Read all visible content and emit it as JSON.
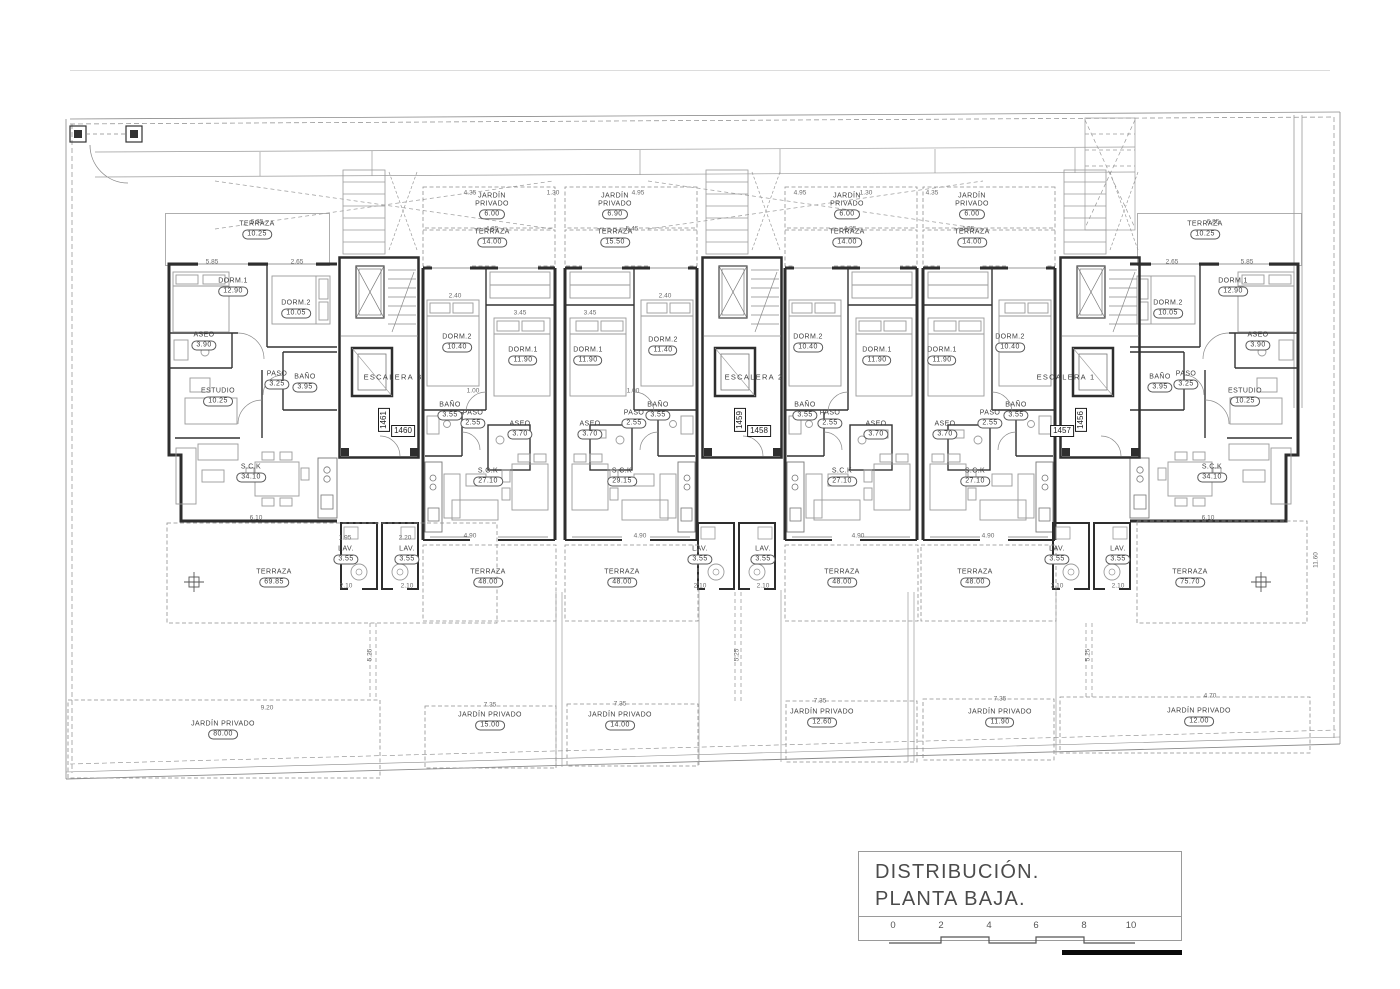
{
  "title_block": {
    "line1": "DISTRIBUCIÓN.",
    "line2": "PLANTA BAJA.",
    "scale_ticks": [
      "0",
      "2",
      "4",
      "6",
      "8",
      "10"
    ]
  },
  "stairwells": [
    {
      "label": "ESCALERA 3",
      "x": 393,
      "y": 377
    },
    {
      "label": "ESCALERA 2",
      "x": 754,
      "y": 377
    },
    {
      "label": "ESCALERA 1",
      "x": 1066,
      "y": 377
    }
  ],
  "plot_numbers": [
    {
      "num": "1461",
      "x": 384,
      "y": 420,
      "vertical": true
    },
    {
      "num": "1460",
      "x": 403,
      "y": 431,
      "vertical": false
    },
    {
      "num": "1459",
      "x": 740,
      "y": 420,
      "vertical": true
    },
    {
      "num": "1458",
      "x": 759,
      "y": 431,
      "vertical": false
    },
    {
      "num": "1457",
      "x": 1062,
      "y": 431,
      "vertical": false
    },
    {
      "num": "1456",
      "x": 1081,
      "y": 420,
      "vertical": true
    }
  ],
  "rooms": [
    {
      "unit": 1,
      "name": "TERRAZA",
      "area": "10.25",
      "x": 257,
      "y": 230
    },
    {
      "unit": 1,
      "name": "DORM.1",
      "area": "12.90",
      "x": 233,
      "y": 287
    },
    {
      "unit": 1,
      "name": "DORM.2",
      "area": "10.05",
      "x": 296,
      "y": 309
    },
    {
      "unit": 1,
      "name": "ASEO",
      "area": "3.90",
      "x": 204,
      "y": 341
    },
    {
      "unit": 1,
      "name": "PASO",
      "area": "3.25",
      "x": 277,
      "y": 380
    },
    {
      "unit": 1,
      "name": "BAÑO",
      "area": "3.95",
      "x": 305,
      "y": 383
    },
    {
      "unit": 1,
      "name": "ESTUDIO",
      "area": "10.25",
      "x": 218,
      "y": 397
    },
    {
      "unit": 1,
      "name": "S.C.K",
      "area": "34.10",
      "x": 251,
      "y": 473
    },
    {
      "unit": 1,
      "name": "LAV.",
      "area": "3.55",
      "x": 346,
      "y": 555
    },
    {
      "unit": 1,
      "name": "TERRAZA",
      "area": "69.85",
      "x": 274,
      "y": 578
    },
    {
      "unit": 1,
      "name": "JARDÍN PRIVADO",
      "area": "80.00",
      "x": 223,
      "y": 730
    },
    {
      "unit": 2,
      "name": "JARDÍN PRIVADO",
      "area": "6.00",
      "x": 492,
      "y": 206,
      "wrap": true
    },
    {
      "unit": 2,
      "name": "TERRAZA",
      "area": "14.00",
      "x": 492,
      "y": 238
    },
    {
      "unit": 2,
      "name": "DORM.2",
      "area": "10.40",
      "x": 457,
      "y": 343
    },
    {
      "unit": 2,
      "name": "DORM.1",
      "area": "11.90",
      "x": 523,
      "y": 356
    },
    {
      "unit": 2,
      "name": "BAÑO",
      "area": "3.55",
      "x": 450,
      "y": 411
    },
    {
      "unit": 2,
      "name": "PASO",
      "area": "2.55",
      "x": 473,
      "y": 419
    },
    {
      "unit": 2,
      "name": "ASEO",
      "area": "3.70",
      "x": 520,
      "y": 430
    },
    {
      "unit": 2,
      "name": "S.C.K",
      "area": "27.10",
      "x": 488,
      "y": 477
    },
    {
      "unit": 2,
      "name": "LAV.",
      "area": "3.55",
      "x": 407,
      "y": 555
    },
    {
      "unit": 2,
      "name": "TERRAZA",
      "area": "48.00",
      "x": 488,
      "y": 578
    },
    {
      "unit": 2,
      "name": "JARDÍN PRIVADO",
      "area": "15.00",
      "x": 490,
      "y": 721
    },
    {
      "unit": 3,
      "name": "JARDÍN PRIVADO",
      "area": "6.90",
      "x": 615,
      "y": 206,
      "wrap": true
    },
    {
      "unit": 3,
      "name": "TERRAZA",
      "area": "15.50",
      "x": 615,
      "y": 238
    },
    {
      "unit": 3,
      "name": "DORM.1",
      "area": "11.90",
      "x": 588,
      "y": 356
    },
    {
      "unit": 3,
      "name": "DORM.2",
      "area": "11.40",
      "x": 663,
      "y": 346
    },
    {
      "unit": 3,
      "name": "ASEO",
      "area": "3.70",
      "x": 590,
      "y": 430
    },
    {
      "unit": 3,
      "name": "PASO",
      "area": "2.55",
      "x": 634,
      "y": 419
    },
    {
      "unit": 3,
      "name": "BAÑO",
      "area": "3.55",
      "x": 658,
      "y": 411
    },
    {
      "unit": 3,
      "name": "S.C.K",
      "area": "29.15",
      "x": 622,
      "y": 477
    },
    {
      "unit": 3,
      "name": "LAV.",
      "area": "3.55",
      "x": 700,
      "y": 555
    },
    {
      "unit": 3,
      "name": "TERRAZA",
      "area": "48.00",
      "x": 622,
      "y": 578
    },
    {
      "unit": 3,
      "name": "JARDÍN PRIVADO",
      "area": "14.00",
      "x": 620,
      "y": 721
    },
    {
      "unit": 4,
      "name": "JARDÍN PRIVADO",
      "area": "6.00",
      "x": 847,
      "y": 206,
      "wrap": true
    },
    {
      "unit": 4,
      "name": "TERRAZA",
      "area": "14.00",
      "x": 847,
      "y": 238
    },
    {
      "unit": 4,
      "name": "DORM.2",
      "area": "10.40",
      "x": 808,
      "y": 343
    },
    {
      "unit": 4,
      "name": "DORM.1",
      "area": "11.90",
      "x": 877,
      "y": 356
    },
    {
      "unit": 4,
      "name": "BAÑO",
      "area": "3.55",
      "x": 805,
      "y": 411
    },
    {
      "unit": 4,
      "name": "PASO",
      "area": "2.55",
      "x": 830,
      "y": 419
    },
    {
      "unit": 4,
      "name": "ASEO",
      "area": "3.70",
      "x": 876,
      "y": 430
    },
    {
      "unit": 4,
      "name": "S.C.K",
      "area": "27.10",
      "x": 842,
      "y": 477
    },
    {
      "unit": 4,
      "name": "LAV.",
      "area": "3.55",
      "x": 763,
      "y": 555
    },
    {
      "unit": 4,
      "name": "TERRAZA",
      "area": "48.00",
      "x": 842,
      "y": 578
    },
    {
      "unit": 4,
      "name": "JARDÍN PRIVADO",
      "area": "12.60",
      "x": 822,
      "y": 718
    },
    {
      "unit": 5,
      "name": "JARDÍN PRIVADO",
      "area": "6.00",
      "x": 972,
      "y": 206,
      "wrap": true
    },
    {
      "unit": 5,
      "name": "TERRAZA",
      "area": "14.00",
      "x": 972,
      "y": 238
    },
    {
      "unit": 5,
      "name": "DORM.1",
      "area": "11.90",
      "x": 942,
      "y": 356
    },
    {
      "unit": 5,
      "name": "DORM.2",
      "area": "10.40",
      "x": 1010,
      "y": 343
    },
    {
      "unit": 5,
      "name": "ASEO",
      "area": "3.70",
      "x": 945,
      "y": 430
    },
    {
      "unit": 5,
      "name": "PASO",
      "area": "2.55",
      "x": 990,
      "y": 419
    },
    {
      "unit": 5,
      "name": "BAÑO",
      "area": "3.55",
      "x": 1016,
      "y": 411
    },
    {
      "unit": 5,
      "name": "S.C.K",
      "area": "27.10",
      "x": 975,
      "y": 477
    },
    {
      "unit": 5,
      "name": "LAV.",
      "area": "3.55",
      "x": 1057,
      "y": 555
    },
    {
      "unit": 5,
      "name": "TERRAZA",
      "area": "48.00",
      "x": 975,
      "y": 578
    },
    {
      "unit": 5,
      "name": "JARDÍN PRIVADO",
      "area": "11.90",
      "x": 1000,
      "y": 718
    },
    {
      "unit": 6,
      "name": "TERRAZA",
      "area": "10.25",
      "x": 1205,
      "y": 230
    },
    {
      "unit": 6,
      "name": "DORM.1",
      "area": "12.90",
      "x": 1233,
      "y": 287
    },
    {
      "unit": 6,
      "name": "DORM.2",
      "area": "10.05",
      "x": 1168,
      "y": 309
    },
    {
      "unit": 6,
      "name": "ASEO",
      "area": "3.90",
      "x": 1258,
      "y": 341
    },
    {
      "unit": 6,
      "name": "BAÑO",
      "area": "3.95",
      "x": 1160,
      "y": 383
    },
    {
      "unit": 6,
      "name": "PASO",
      "area": "3.25",
      "x": 1186,
      "y": 380
    },
    {
      "unit": 6,
      "name": "ESTUDIO",
      "area": "10.25",
      "x": 1245,
      "y": 397
    },
    {
      "unit": 6,
      "name": "S.C.K",
      "area": "34.10",
      "x": 1212,
      "y": 473
    },
    {
      "unit": 6,
      "name": "LAV.",
      "area": "3.55",
      "x": 1118,
      "y": 555
    },
    {
      "unit": 6,
      "name": "TERRAZA",
      "area": "75.70",
      "x": 1190,
      "y": 578
    },
    {
      "unit": 6,
      "name": "JARDÍN PRIVADO",
      "area": "12.00",
      "x": 1199,
      "y": 717
    }
  ],
  "dims": [
    {
      "t": "6.85",
      "x": 257,
      "y": 222
    },
    {
      "t": "6.85",
      "x": 1213,
      "y": 222
    },
    {
      "t": "4.35",
      "x": 470,
      "y": 193
    },
    {
      "t": "1.30",
      "x": 553,
      "y": 193
    },
    {
      "t": "4.95",
      "x": 638,
      "y": 193
    },
    {
      "t": "4.95",
      "x": 800,
      "y": 193
    },
    {
      "t": "1.30",
      "x": 866,
      "y": 193
    },
    {
      "t": "4.35",
      "x": 932,
      "y": 193
    },
    {
      "t": "4.85",
      "x": 492,
      "y": 229
    },
    {
      "t": "5.45",
      "x": 632,
      "y": 229
    },
    {
      "t": "4.85",
      "x": 850,
      "y": 229
    },
    {
      "t": "4.85",
      "x": 968,
      "y": 229
    },
    {
      "t": "5.85",
      "x": 212,
      "y": 262
    },
    {
      "t": "2.65",
      "x": 297,
      "y": 262
    },
    {
      "t": "2.65",
      "x": 1172,
      "y": 262
    },
    {
      "t": "5.85",
      "x": 1247,
      "y": 262
    },
    {
      "t": "2.40",
      "x": 455,
      "y": 296
    },
    {
      "t": "3.45",
      "x": 520,
      "y": 313
    },
    {
      "t": "3.45",
      "x": 590,
      "y": 313
    },
    {
      "t": "2.40",
      "x": 665,
      "y": 296
    },
    {
      "t": "1.00",
      "x": 473,
      "y": 391
    },
    {
      "t": "1.00",
      "x": 633,
      "y": 391
    },
    {
      "t": "4.90",
      "x": 470,
      "y": 536
    },
    {
      "t": "4.90",
      "x": 640,
      "y": 536
    },
    {
      "t": "4.90",
      "x": 858,
      "y": 536
    },
    {
      "t": "4.90",
      "x": 988,
      "y": 536
    },
    {
      "t": "6.10",
      "x": 256,
      "y": 518
    },
    {
      "t": "6.10",
      "x": 1208,
      "y": 518
    },
    {
      "t": "1.95",
      "x": 345,
      "y": 538
    },
    {
      "t": "2.20",
      "x": 405,
      "y": 538
    },
    {
      "t": "2.10",
      "x": 346,
      "y": 586
    },
    {
      "t": "2.10",
      "x": 407,
      "y": 586
    },
    {
      "t": "2.10",
      "x": 700,
      "y": 586
    },
    {
      "t": "2.10",
      "x": 763,
      "y": 586
    },
    {
      "t": "2.10",
      "x": 1057,
      "y": 586
    },
    {
      "t": "2.10",
      "x": 1118,
      "y": 586
    },
    {
      "t": "9.20",
      "x": 267,
      "y": 708
    },
    {
      "t": "7.35",
      "x": 490,
      "y": 705
    },
    {
      "t": "7.35",
      "x": 620,
      "y": 704
    },
    {
      "t": "7.35",
      "x": 820,
      "y": 701
    },
    {
      "t": "7.35",
      "x": 1000,
      "y": 699
    },
    {
      "t": "4.70",
      "x": 1210,
      "y": 696
    },
    {
      "t": "5.25",
      "x": 370,
      "y": 655,
      "rot": true
    },
    {
      "t": "5.25",
      "x": 737,
      "y": 655,
      "rot": true
    },
    {
      "t": "5.25",
      "x": 1088,
      "y": 655,
      "rot": true
    },
    {
      "t": "11.60",
      "x": 1316,
      "y": 560,
      "rot": true
    }
  ]
}
